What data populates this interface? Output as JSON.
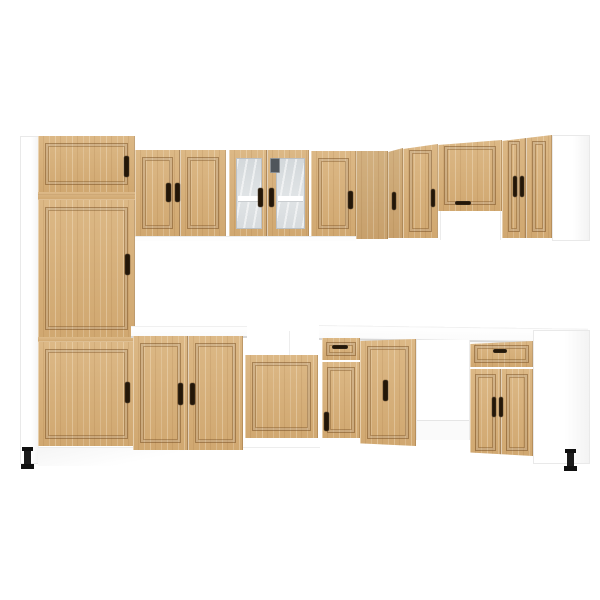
{
  "scene": {
    "title": "L-shaped kitchen cabinet set in artisan oak and white",
    "type": "product-photo",
    "background_color": "#ffffff"
  },
  "palette": {
    "wood": "#d8b078",
    "wood_shadow": "#b3894f",
    "handle_black": "#241708",
    "carcass_white": "#ffffff",
    "edge_gray": "#e9e9e9",
    "glass_gray": "#d7dbde",
    "counter_edge": "#d8d8d8",
    "foot_black": "#1a1a1a"
  },
  "units": {
    "tall_pantry": {
      "label": "Tall pantry cabinet with 3 doors",
      "doors": 3,
      "handles": 3
    },
    "wall_double": {
      "label": "Double-door wall cabinet",
      "doors": 2
    },
    "wall_glass": {
      "label": "Glass double-door wall cabinet with shelf",
      "doors": 2,
      "shelves": 1
    },
    "wall_single": {
      "label": "Single-door wall cabinet",
      "doors": 1
    },
    "corner_filler_upper": {
      "label": "Corner wall filler panel"
    },
    "wing_wall_door_a": {
      "label": "Side-wing wall cabinet door",
      "doors": 1
    },
    "wing_wall_door_b": {
      "label": "Side-wing wall cabinet door",
      "doors": 1
    },
    "hood_cabinet": {
      "label": "Extractor-hood wall cabinet with open recess",
      "doors": 1
    },
    "wing_wall_double": {
      "label": "Side-wing double-door wall cabinet",
      "doors": 2
    },
    "upper_end_panel": {
      "label": "White wall-cabinet end panel"
    },
    "sink_base": {
      "label": "Double-door sink base cabinet with white countertop",
      "doors": 2
    },
    "hob_base": {
      "label": "Single-door base cabinet",
      "doors": 1
    },
    "corner_drawer_base": {
      "label": "Base cabinet with drawer and door",
      "doors": 1,
      "drawers": 1
    },
    "wing_base_door": {
      "label": "Side-wing single-door base cabinet",
      "doors": 1
    },
    "appliance_gap": {
      "label": "Open bay for built-in appliance"
    },
    "wing_drawer_base": {
      "label": "Side-wing base cabinet with drawer and double doors",
      "doors": 2,
      "drawers": 1
    },
    "base_end_panel": {
      "label": "White base-cabinet end panel"
    },
    "countertop": {
      "label": "White worktop"
    },
    "feet": {
      "label": "Black adjustable feet",
      "count": 2
    }
  }
}
